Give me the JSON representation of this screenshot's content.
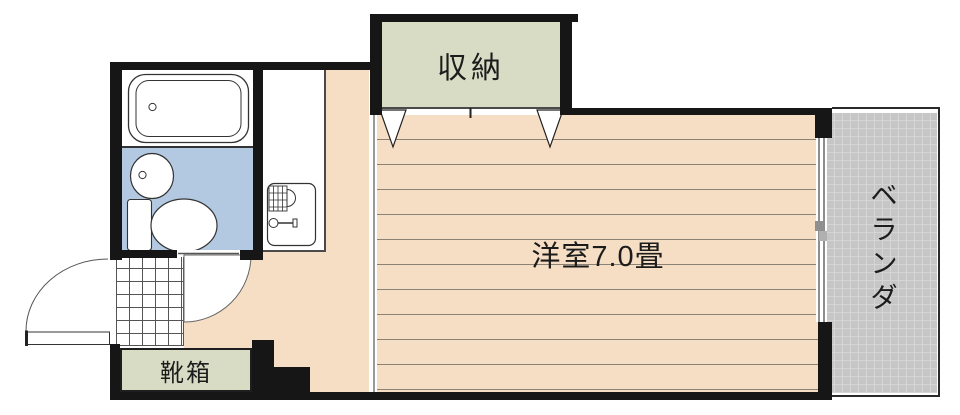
{
  "floorplan": {
    "labels": {
      "closet": "収納",
      "western_room": "洋室7.0畳",
      "shoe_box": "靴箱",
      "veranda": "ベランダ"
    },
    "veranda_chars": [
      "ベ",
      "ラ",
      "ン",
      "ダ"
    ],
    "colors": {
      "wall": "#161616",
      "flooring": "#f6dec4",
      "flooring_line": "#8b8274",
      "closet_fill": "#d9dcc5",
      "bathroom_fill": "#b3c9e1",
      "veranda_fill": "#c6c6c6",
      "veranda_grid": "#d5d5d5"
    }
  }
}
